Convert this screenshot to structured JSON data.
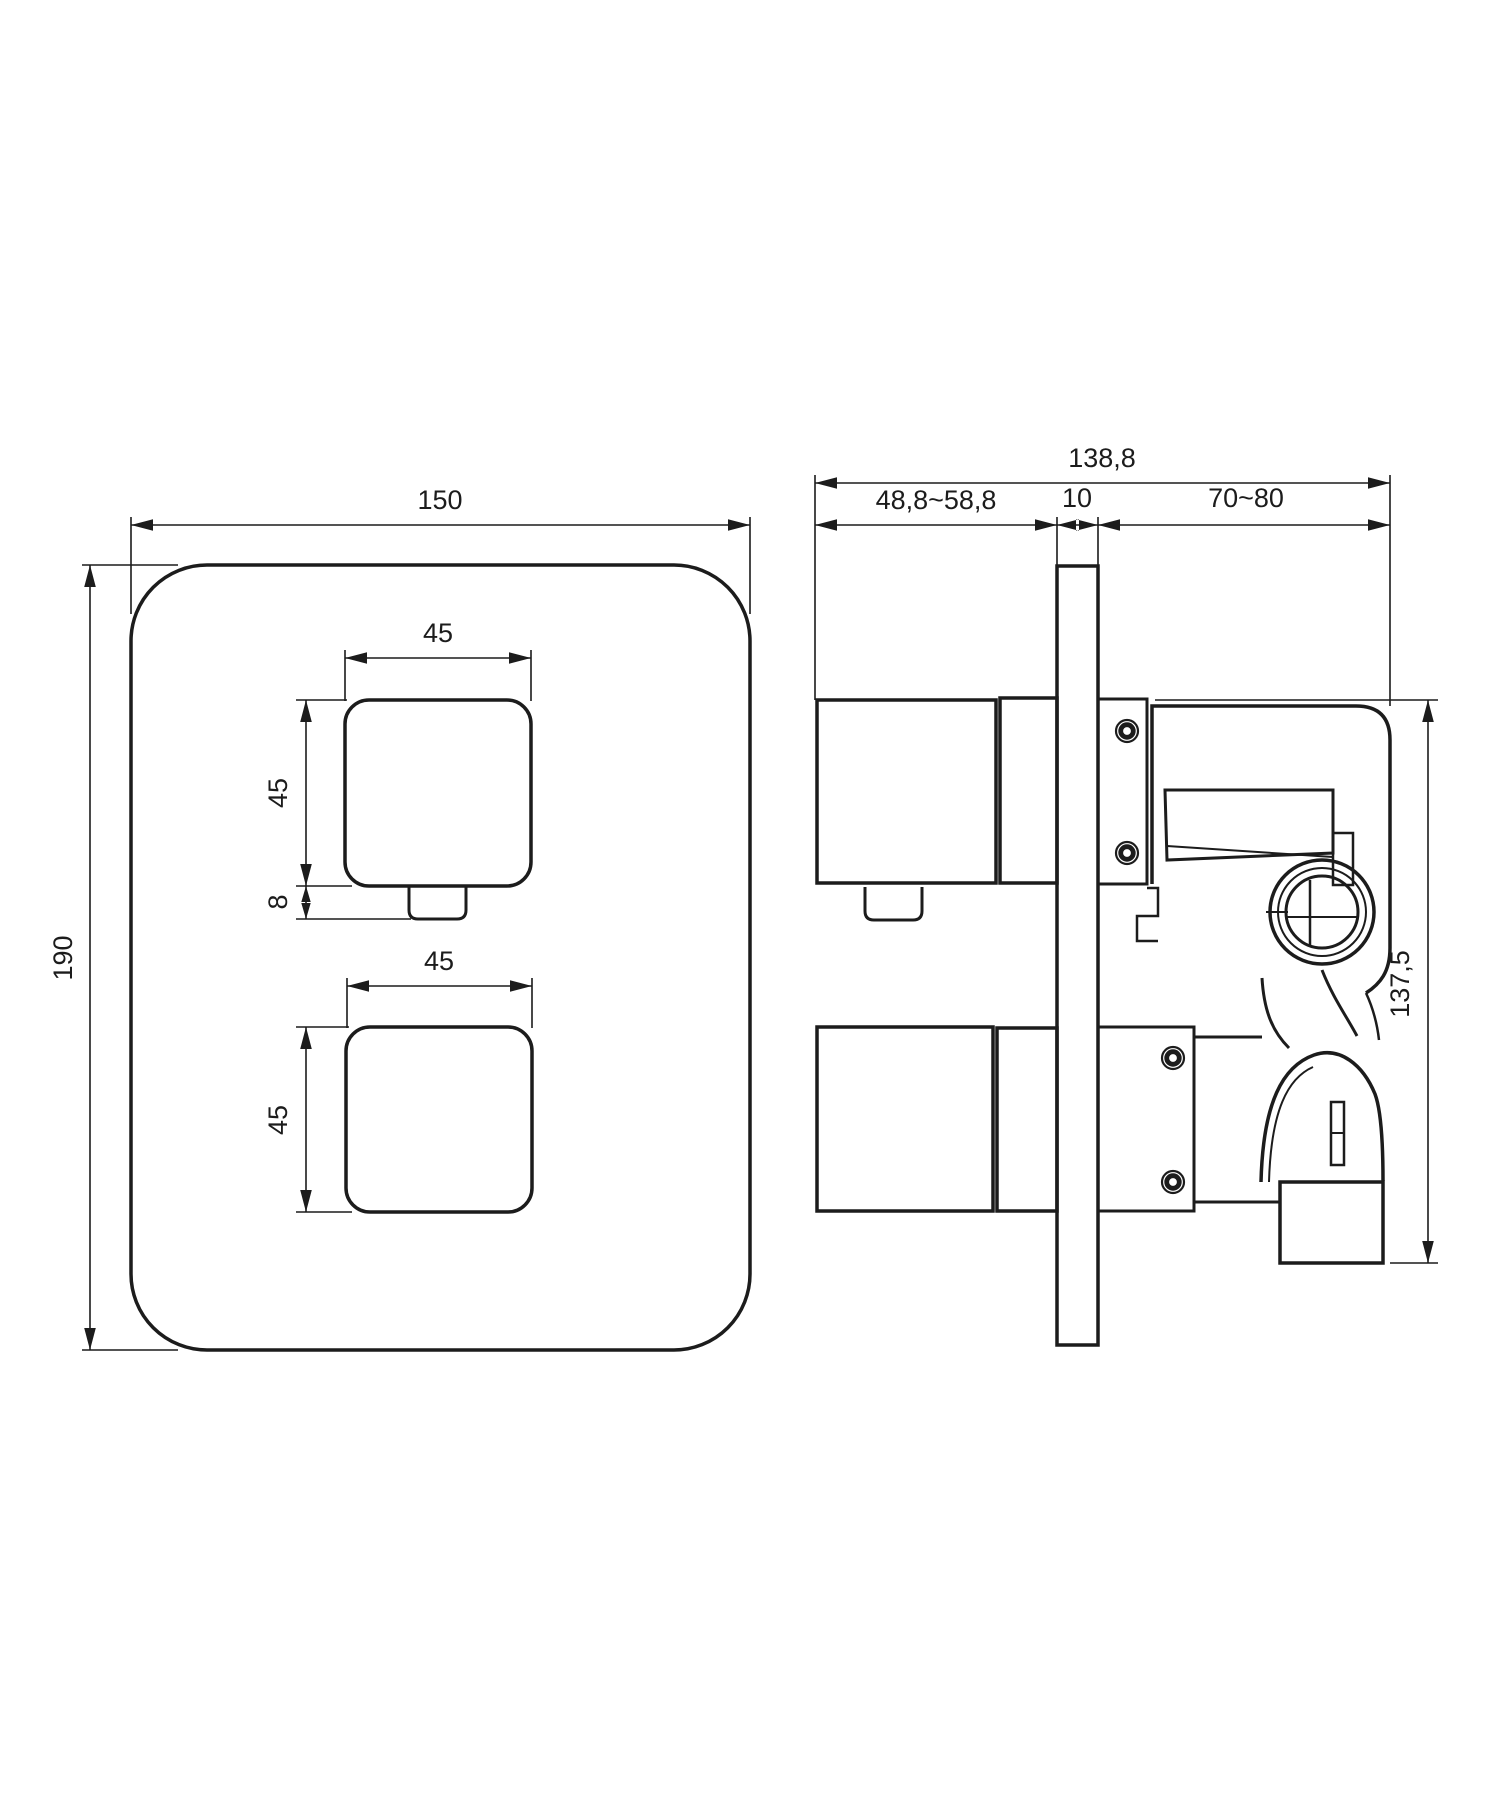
{
  "page": {
    "background": "#ffffff",
    "ink_color": "#1c1c1c"
  },
  "front_view": {
    "description": "front view of square concealed-mixer faceplate with two square knobs",
    "dim_width": "150",
    "dim_height": "190",
    "top_knob": {
      "dim_width": "45",
      "dim_height": "45",
      "dim_tab_height": "8"
    },
    "bottom_knob": {
      "dim_width": "45",
      "dim_height": "45"
    }
  },
  "side_view": {
    "description": "side section of concealed valve body through wall plate",
    "dim_total_depth": "138,8",
    "dim_trim_depth": "48,8~58,8",
    "dim_plate_thickness": "10",
    "dim_rough_in_depth": "70~80",
    "dim_body_height": "137,5"
  }
}
